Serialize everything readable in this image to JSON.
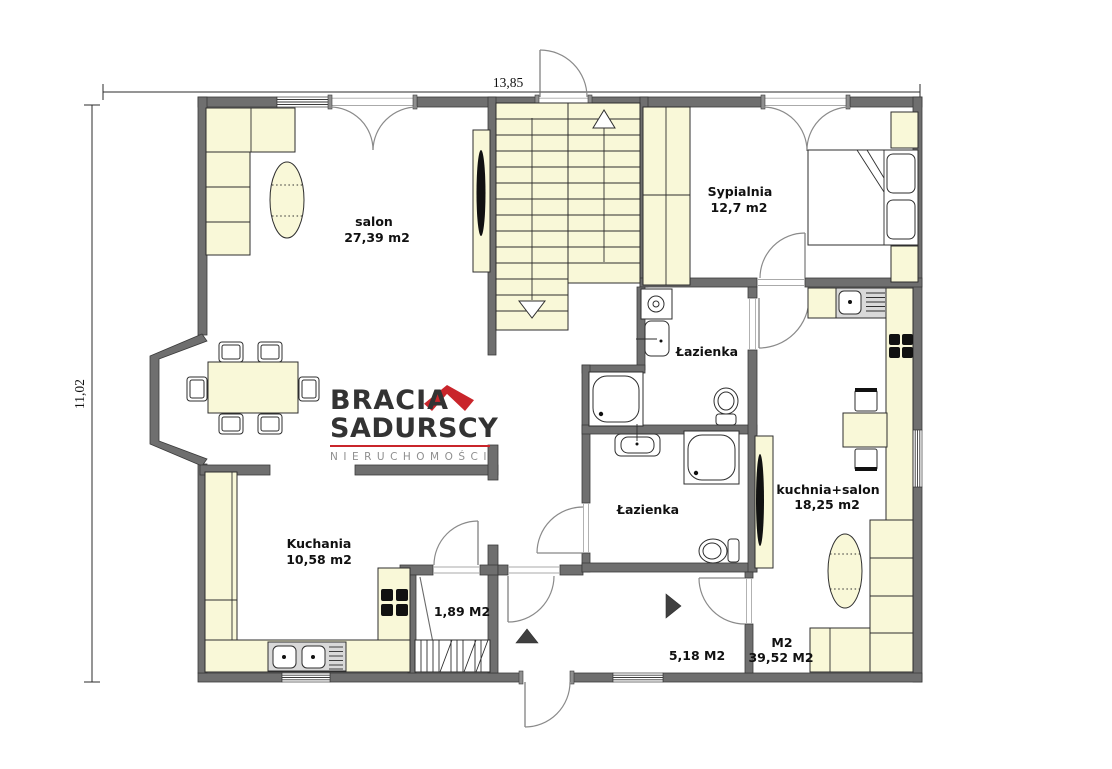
{
  "meta": {
    "type": "apartment-floor-plan"
  },
  "dimensions": {
    "top": "13,85",
    "left": "11,02"
  },
  "rooms": {
    "salon": {
      "name": "salon",
      "area": "27,39 m2"
    },
    "sypialnia": {
      "name": "Sypialnia",
      "area": "12,7 m2"
    },
    "lazienka_upper": {
      "name": "Łazienka"
    },
    "lazienka_lower": {
      "name": "Łazienka"
    },
    "kuchnia_salon": {
      "name": "kuchnia+salon",
      "area": "18,25 m2"
    },
    "kuchnia": {
      "name": "Kuchania",
      "area": "10,58 m2"
    },
    "schowek": {
      "area": "1,89 M2"
    },
    "hol": {
      "area": "5,18 M2"
    },
    "m2": {
      "name": "M2",
      "area": "39,52 M2"
    }
  },
  "logo": {
    "brand_line1": "BRACIA",
    "brand_line2": "SADURSCY",
    "brand_subtitle": "NIERUCHOMOŚCI"
  },
  "colors": {
    "wall": "#6f6f6f",
    "wall_edge": "#3a3a3a",
    "furniture_fill": "#f9f8d8",
    "fixture_gray": "#d9d9d9",
    "logo_red": "#c9252b",
    "logo_dark": "#333333",
    "logo_gray": "#8f8f8f",
    "label_text": "#111111"
  }
}
